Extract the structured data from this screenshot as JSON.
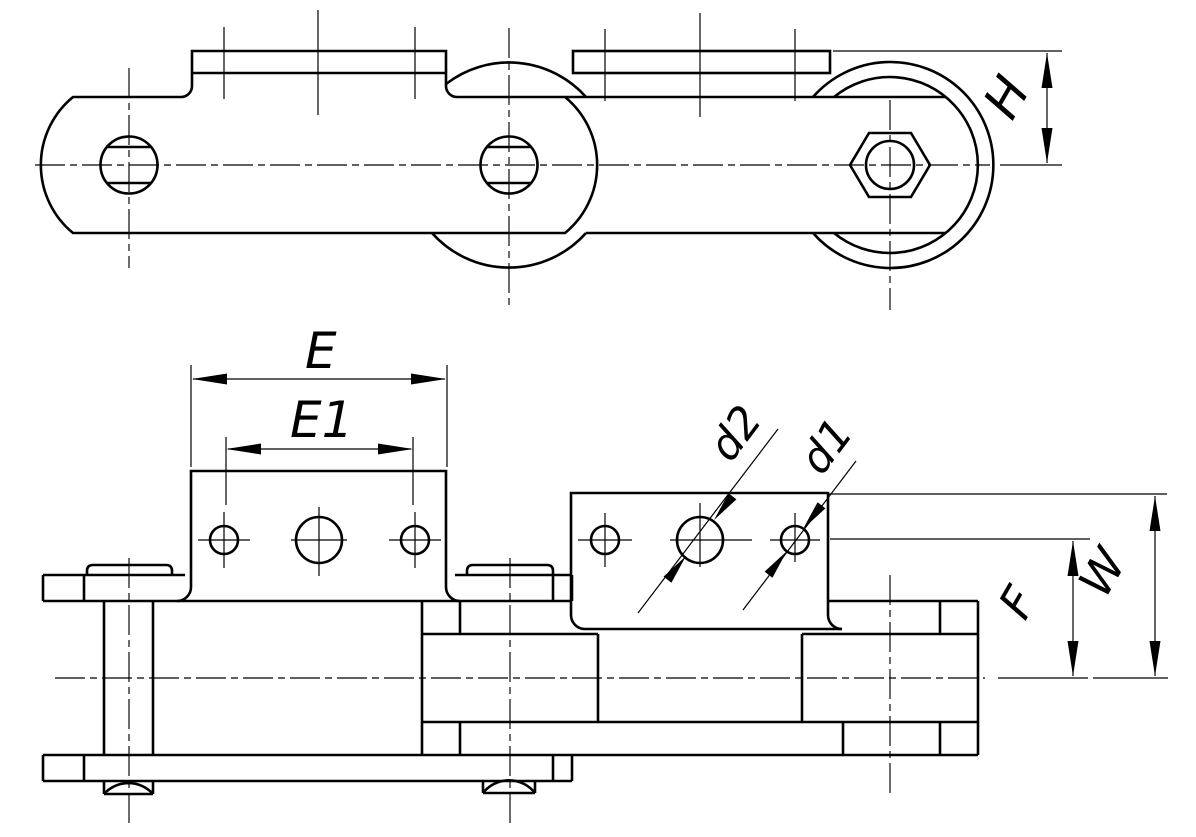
{
  "drawing": {
    "title": "roller-chain-attachment-drawing",
    "colors": {
      "line": "#000000",
      "background": "#ffffff"
    },
    "labels": {
      "E": "E",
      "E1": "E1",
      "d2": "d2",
      "d1": "d1",
      "H": "H",
      "F": "F",
      "W": "W"
    }
  }
}
